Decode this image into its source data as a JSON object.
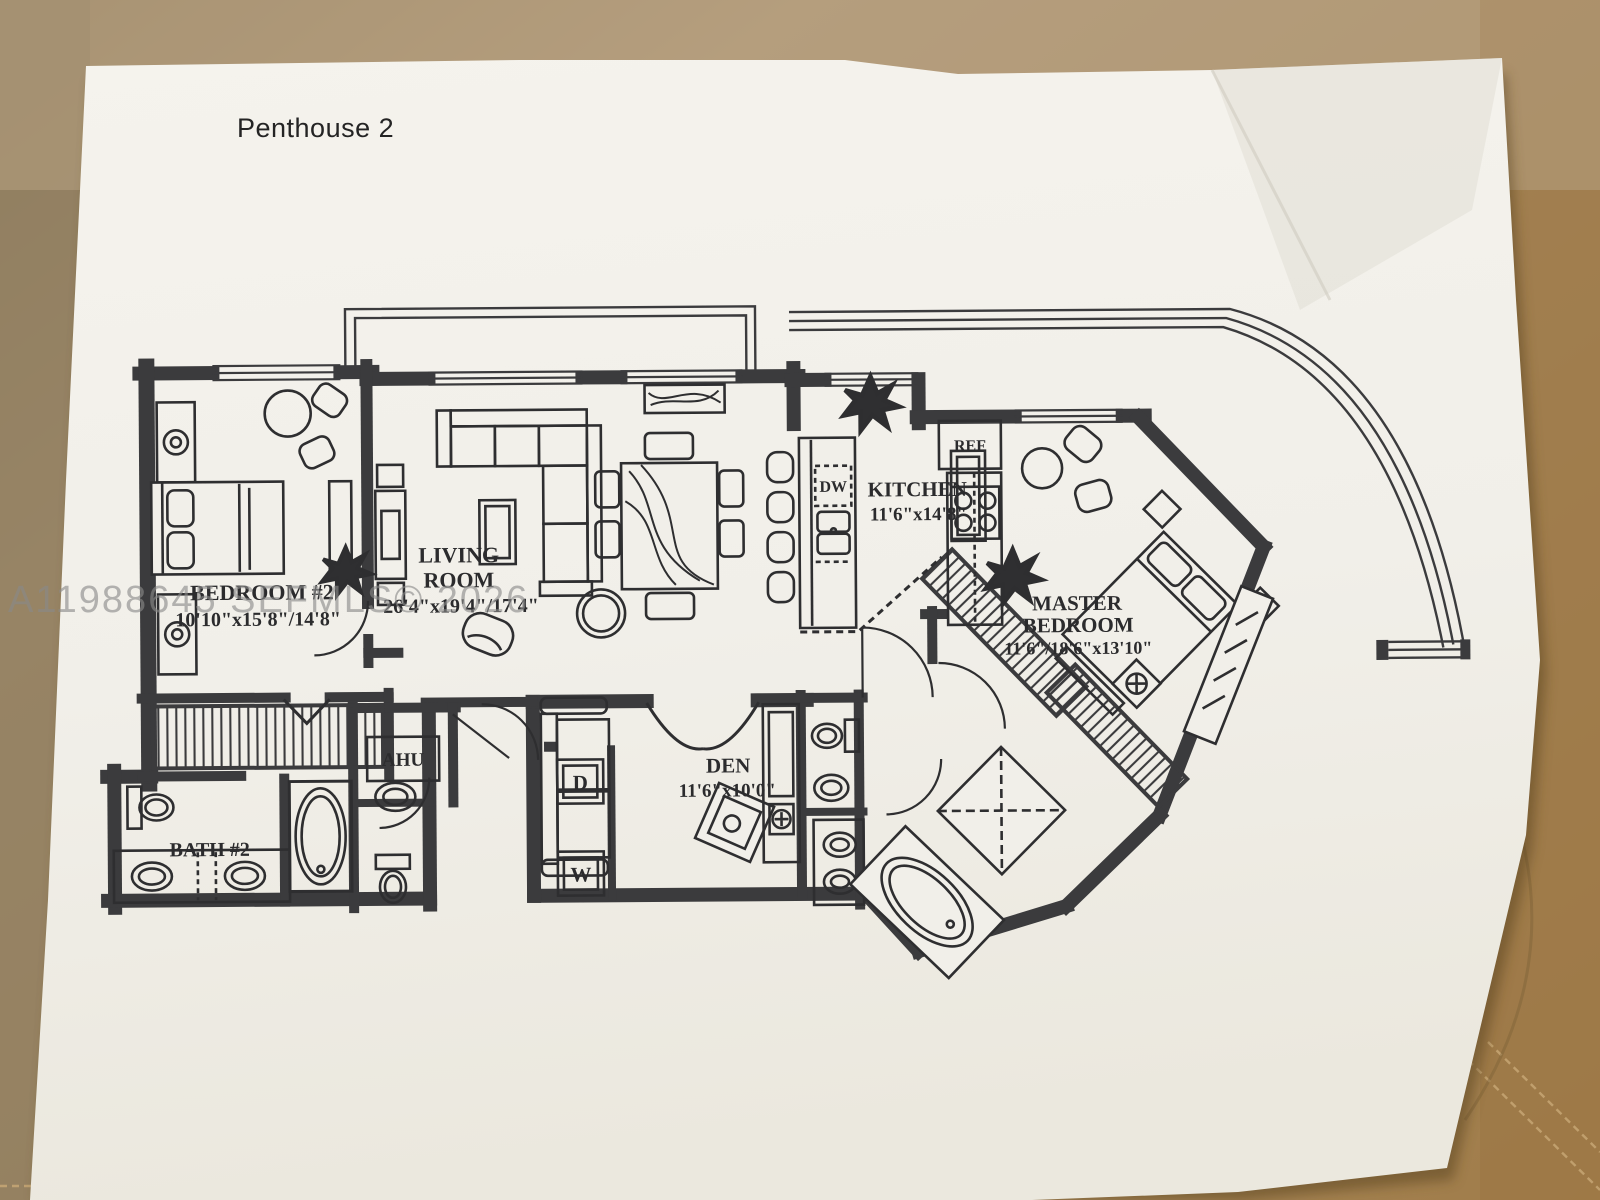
{
  "photo": {
    "title": "Penthouse 2",
    "watermark": "A11988645 SEFMLS© 2026"
  },
  "rooms": {
    "bedroom2": {
      "name": "BEDROOM #2",
      "dims": "10'10\"x15'8\"/14'8\""
    },
    "living": {
      "name_line1": "LIVING",
      "name_line2": "ROOM",
      "dims": "26'4\"x19'4\"/17'4\""
    },
    "kitchen": {
      "name": "KITCHEN",
      "dims": "11'6\"x14'8\""
    },
    "master": {
      "name_line1": "MASTER",
      "name_line2": "BEDROOM",
      "dims": "11'6\"/18'6\"x13'10\""
    },
    "den": {
      "name": "DEN",
      "dims": "11'6\"x10'0\""
    },
    "bath2": {
      "name": "BATH #2"
    }
  },
  "fixtures": {
    "ref": "REF",
    "dw": "DW",
    "ahu": "AHU",
    "dryer": "D",
    "washer": "W"
  },
  "colors": {
    "leather": "#ab8e66",
    "leather_dark": "#8e7c5f",
    "leather_right": "#a07c49",
    "paper": "#f2f0ea",
    "ink": "#3b3b3d"
  }
}
